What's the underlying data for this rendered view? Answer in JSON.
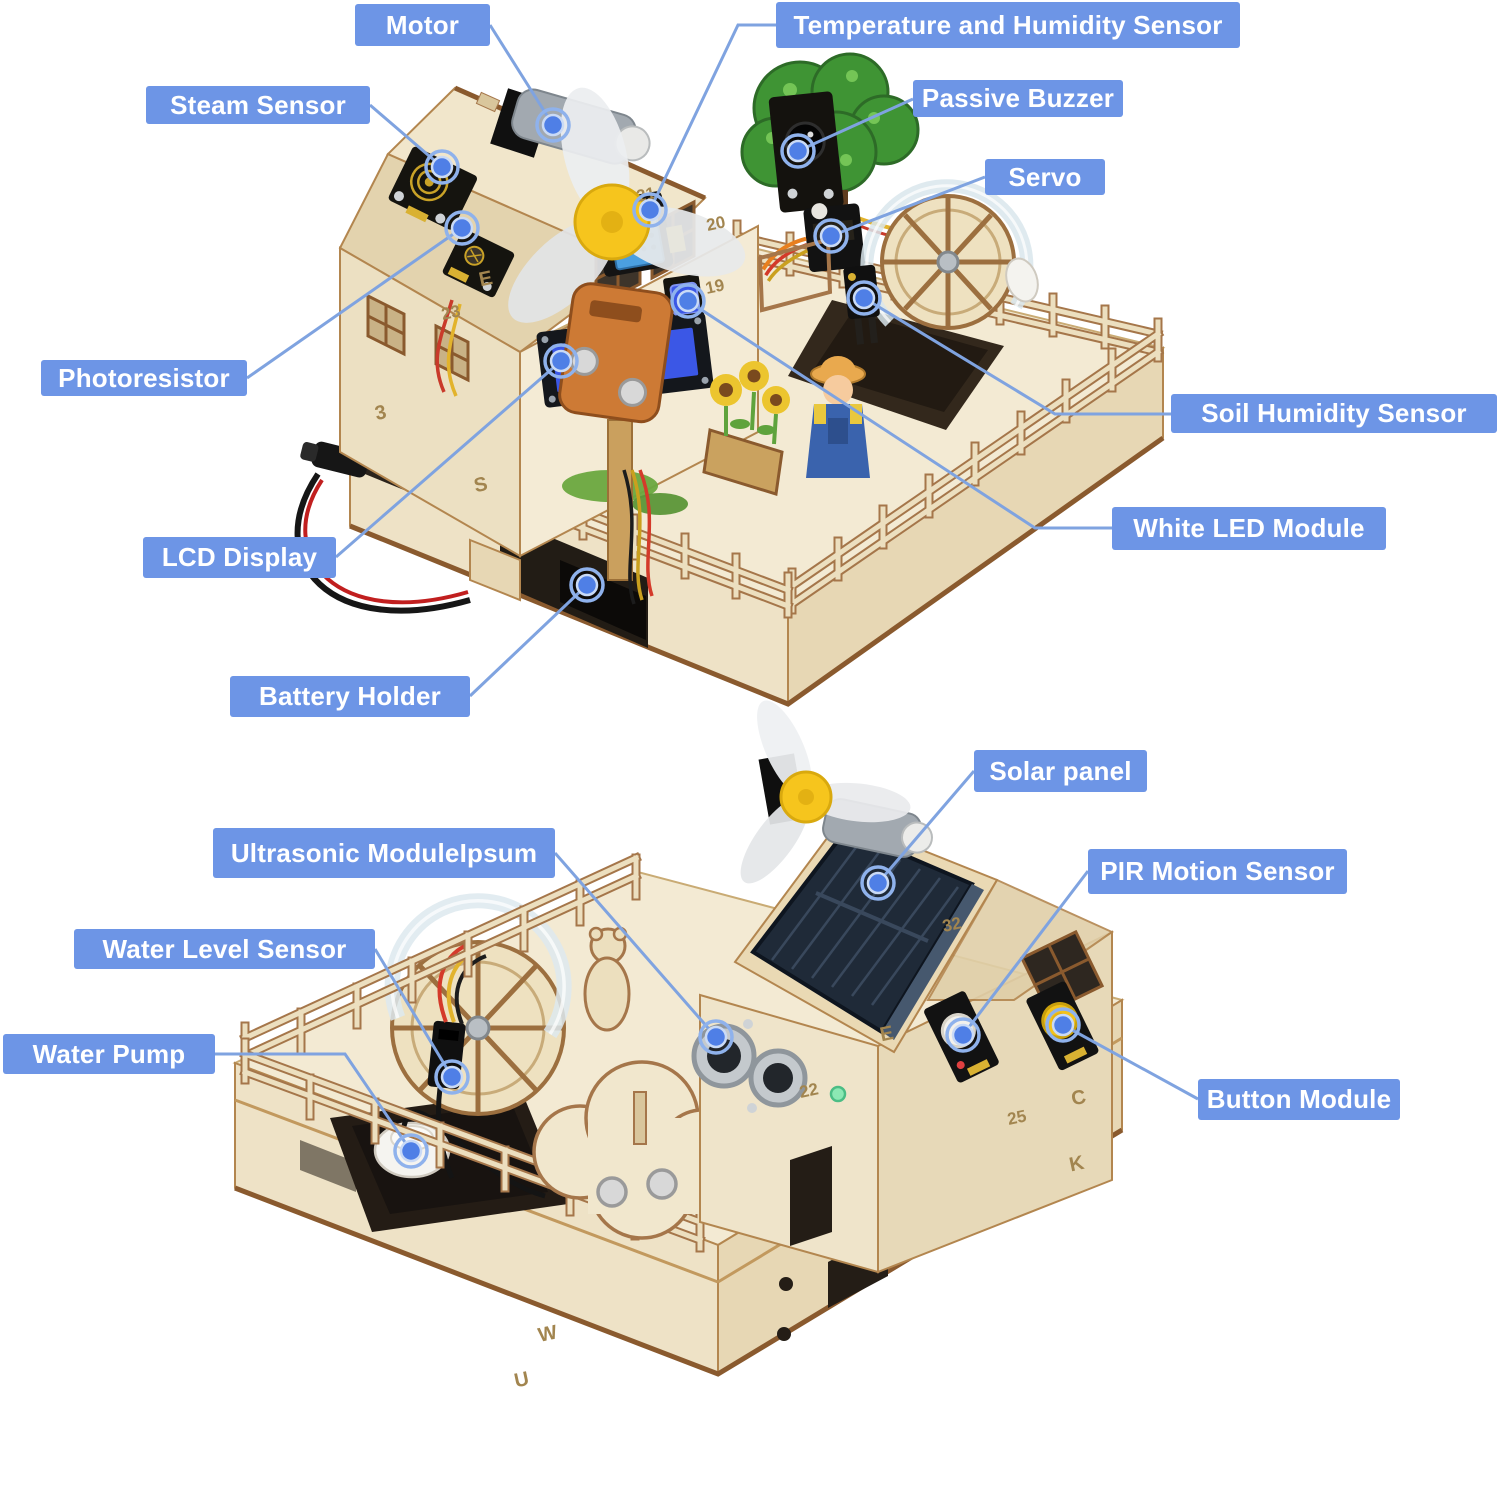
{
  "title": "STEM smart farm kit — annotated components",
  "colors": {
    "background": "#ffffff",
    "label_bg": "#6d95e6",
    "label_text": "#ffffff",
    "leader": "#7fa3e0",
    "dot": "#4f7fe6",
    "dot_ring": "#8fb2ec",
    "wood_face": "#f3ead3",
    "wood_side": "#e7d7b4",
    "wood_edge": "#a5764a",
    "solar": "#1f2a38",
    "lcd_screen": "#3b57e6",
    "fan_hub": "#f6c51d"
  },
  "lcd": {
    "line1": "keyes",
    "line2": "32.8"
  },
  "labels": [
    {
      "id": "motor",
      "text": "Motor",
      "x": 355,
      "y": 4,
      "w": 135,
      "h": 42,
      "line": [
        [
          490,
          25
        ],
        [
          553,
          125
        ]
      ]
    },
    {
      "id": "temperature-humidity-sensor",
      "text": "Temperature and Humidity Sensor",
      "x": 776,
      "y": 2,
      "w": 464,
      "h": 46,
      "line": [
        [
          776,
          25
        ],
        [
          738,
          25
        ],
        [
          650,
          210
        ]
      ]
    },
    {
      "id": "steam-sensor",
      "text": "Steam Sensor",
      "x": 146,
      "y": 86,
      "w": 224,
      "h": 38,
      "line": [
        [
          370,
          105
        ],
        [
          442,
          167
        ]
      ]
    },
    {
      "id": "passive-buzzer",
      "text": "Passive Buzzer",
      "x": 913,
      "y": 80,
      "w": 210,
      "h": 37,
      "line": [
        [
          913,
          99
        ],
        [
          798,
          151
        ]
      ]
    },
    {
      "id": "servo",
      "text": "Servo",
      "x": 985,
      "y": 159,
      "w": 120,
      "h": 36,
      "line": [
        [
          985,
          177
        ],
        [
          831,
          236
        ]
      ]
    },
    {
      "id": "photoresistor",
      "text": "Photoresistor",
      "x": 41,
      "y": 360,
      "w": 206,
      "h": 36,
      "line": [
        [
          247,
          378
        ],
        [
          462,
          228
        ]
      ]
    },
    {
      "id": "soil-humidity-sensor",
      "text": "Soil Humidity Sensor",
      "x": 1171,
      "y": 394,
      "w": 326,
      "h": 39,
      "line": [
        [
          1171,
          414
        ],
        [
          1055,
          414
        ],
        [
          864,
          298
        ]
      ]
    },
    {
      "id": "white-led-module",
      "text": "White LED Module",
      "x": 1112,
      "y": 507,
      "w": 274,
      "h": 43,
      "line": [
        [
          1112,
          528
        ],
        [
          1035,
          528
        ],
        [
          688,
          301
        ]
      ]
    },
    {
      "id": "lcd-display",
      "text": "LCD Display",
      "x": 143,
      "y": 537,
      "w": 193,
      "h": 41,
      "line": [
        [
          336,
          557
        ],
        [
          561,
          361
        ]
      ]
    },
    {
      "id": "battery-holder",
      "text": "Battery Holder",
      "x": 230,
      "y": 676,
      "w": 240,
      "h": 41,
      "line": [
        [
          470,
          696
        ],
        [
          587,
          585
        ]
      ]
    },
    {
      "id": "solar-panel",
      "text": "Solar panel",
      "x": 974,
      "y": 750,
      "w": 173,
      "h": 42,
      "line": [
        [
          974,
          771
        ],
        [
          878,
          883
        ]
      ]
    },
    {
      "id": "ultrasonic-module",
      "text": "Ultrasonic ModuleIpsum",
      "x": 213,
      "y": 828,
      "w": 342,
      "h": 50,
      "line": [
        [
          555,
          853
        ],
        [
          716,
          1037
        ]
      ]
    },
    {
      "id": "pir-motion-sensor",
      "text": "PIR Motion Sensor",
      "x": 1088,
      "y": 849,
      "w": 259,
      "h": 45,
      "line": [
        [
          1088,
          871
        ],
        [
          963,
          1035
        ]
      ]
    },
    {
      "id": "button-module",
      "text": "Button Module",
      "x": 1198,
      "y": 1079,
      "w": 202,
      "h": 41,
      "line": [
        [
          1198,
          1099
        ],
        [
          1063,
          1025
        ]
      ]
    },
    {
      "id": "water-level-sensor",
      "text": "Water Level Sensor",
      "x": 74,
      "y": 929,
      "w": 301,
      "h": 40,
      "line": [
        [
          375,
          949
        ],
        [
          452,
          1077
        ]
      ]
    },
    {
      "id": "water-pump",
      "text": "Water Pump",
      "x": 3,
      "y": 1034,
      "w": 212,
      "h": 40,
      "line": [
        [
          215,
          1054
        ],
        [
          345,
          1054
        ],
        [
          411,
          1151
        ]
      ]
    }
  ],
  "engravings": [
    {
      "t": "21",
      "x": 647,
      "y": 200
    },
    {
      "t": "20",
      "x": 717,
      "y": 229
    },
    {
      "t": "19",
      "x": 716,
      "y": 292
    },
    {
      "t": "23",
      "x": 452,
      "y": 318
    },
    {
      "t": "E",
      "x": 487,
      "y": 285
    },
    {
      "t": "3",
      "x": 382,
      "y": 419
    },
    {
      "t": "S",
      "x": 482,
      "y": 491
    },
    {
      "t": "32",
      "x": 953,
      "y": 930
    },
    {
      "t": "E",
      "x": 888,
      "y": 1040
    },
    {
      "t": "22",
      "x": 810,
      "y": 1096
    },
    {
      "t": "C",
      "x": 1080,
      "y": 1104
    },
    {
      "t": "25",
      "x": 1018,
      "y": 1123
    },
    {
      "t": "K",
      "x": 1078,
      "y": 1170
    },
    {
      "t": "W",
      "x": 549,
      "y": 1340
    },
    {
      "t": "U",
      "x": 523,
      "y": 1386
    }
  ]
}
